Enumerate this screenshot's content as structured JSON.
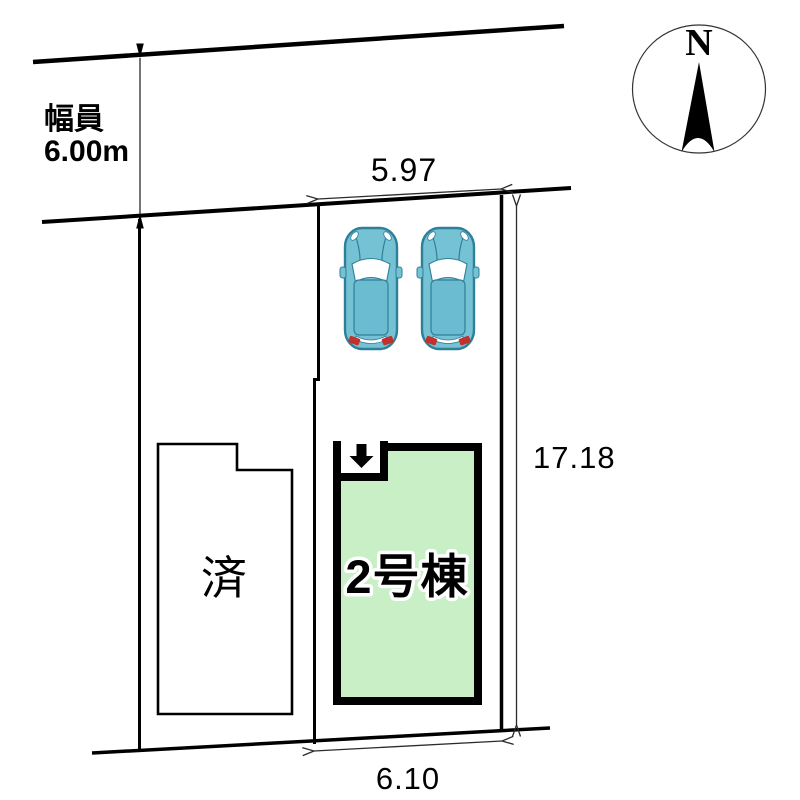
{
  "plan": {
    "title": "site-plan",
    "road": {
      "width_label": "幅員",
      "width_value": "6.00m"
    },
    "compass": {
      "north_label": "N"
    },
    "dimensions": {
      "frontage_top": "5.97",
      "depth_right": "17.18",
      "frontage_bottom": "6.10"
    },
    "buildings": {
      "sold": {
        "label": "済",
        "fill": "#ffffff"
      },
      "unit2": {
        "label": "2号棟",
        "fill": "#c9efc7"
      }
    },
    "cars": {
      "count": 2,
      "body_color": "#76c2d5",
      "roof_color": "#6cbcd1",
      "outline_color": "#2e7f98",
      "window_color": "#ffffff",
      "taillight_color": "#c4302b"
    },
    "icons": {
      "north_arrow": "north-compass-needle",
      "car": "car-top-view",
      "entrance": "entrance-down-arrow"
    }
  }
}
